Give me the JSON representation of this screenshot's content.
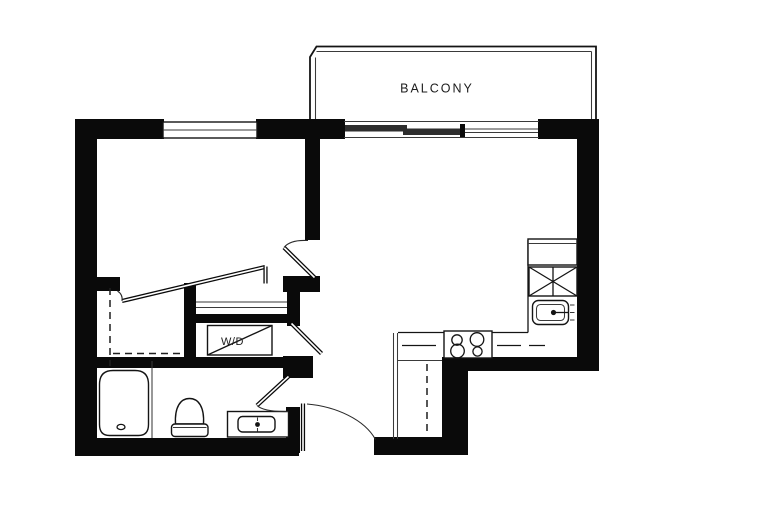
{
  "document": {
    "type": "apartment-floor-plan",
    "background_color": "#ffffff"
  },
  "labels": {
    "balcony": "BALCONY",
    "washer_dryer": "W/D"
  },
  "colors": {
    "wall_fill": "#0a0a0a",
    "line": "#141414",
    "slider_panel": "#2e2e2e",
    "label_text": "#1c1c1c"
  },
  "icons": [
    "bathtub",
    "toilet",
    "vanity-sink",
    "washer-dryer-unit",
    "stove-cooktop",
    "kitchen-sink",
    "refrigerator",
    "balcony-sliding-door",
    "bedroom-window",
    "entry-door-swing",
    "bedroom-door-swing",
    "bathroom-door-swing",
    "laundry-door",
    "closet-rod-dashed-lines"
  ]
}
